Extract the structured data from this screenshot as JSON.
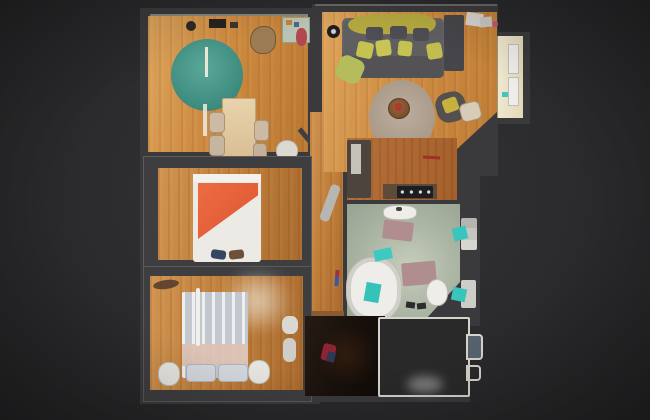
{
  "scene": {
    "type": "3d-dollhouse-top-down-view",
    "description": "Top-down dollhouse view of a scanned multi-room apartment floating on a dark background",
    "visible_text": "none",
    "background_color": "#2b2b2d",
    "wall_color": "#3a3a3d",
    "unscanned_room_outline_color": "#d6d3cc"
  },
  "palette": {
    "wood_floor_light": "#cd8a40",
    "wood_floor_dark": "#a96a2e",
    "teal_rug": "#4a9c8e",
    "beige_rug": "#b3a496",
    "sofa_gray": "#5f5f62",
    "pillow_yellow": "#c6c252",
    "blanket_mustard": "#b4a93f",
    "bed_blanket_orange": "#e4603a",
    "bathroom_tile_green": "#aab4a2",
    "towel_teal": "#3bc8be",
    "bath_mat_mauve": "#b08d8e",
    "entry_floor_dark": "#1c130e",
    "balcony_cream": "#efe8cf"
  },
  "rooms": [
    {
      "id": "dining-room",
      "label": "dining room",
      "furniture": [
        "teal round rug",
        "pale wood dining table",
        "four beige chairs",
        "top shelf objects",
        "kitchenette nook with counter and red figure",
        "white corner radiator",
        "open door leaf"
      ]
    },
    {
      "id": "living-room",
      "label": "living room",
      "furniture": [
        "gray sofa",
        "mustard throw blanket",
        "yellow cushions",
        "dark cushions",
        "green throw",
        "black round speaker",
        "round beige rug",
        "round coffee table",
        "dark armchair with yellow pillow",
        "side stool",
        "dark wardrobe",
        "white boxes near wall",
        "balcony window bay"
      ]
    },
    {
      "id": "kitchen",
      "label": "kitchen strip",
      "furniture": [
        "dark fridge cabinet with open light door",
        "counter with black cooktop",
        "red bar on floor"
      ]
    },
    {
      "id": "bathroom",
      "label": "bathroom",
      "furniture": [
        "white sink",
        "two mauve bath mats",
        "oval bathtub with teal towels",
        "toilet",
        "dark slippers",
        "wall shelves with teal towels"
      ]
    },
    {
      "id": "bedroom-1",
      "label": "bedroom with orange bed",
      "furniture": [
        "double bed with diagonal orange blanket",
        "two dark slippers at foot of bed"
      ]
    },
    {
      "id": "bedroom-2",
      "label": "bedroom with white bed",
      "furniture": [
        "double bed with pale striped duvet",
        "two quilted pillows",
        "white lamp pole",
        "two white nightstands",
        "white chair",
        "white bench",
        "privacy blur haze"
      ]
    },
    {
      "id": "hallway",
      "label": "central hallway",
      "furniture": [
        "leaning gray board",
        "small red-blue broom",
        "wooden threshold"
      ]
    },
    {
      "id": "entry-dark-room",
      "label": "unlit entry room",
      "furniture": [
        "red jacket on floor",
        "gray haze blob"
      ]
    },
    {
      "id": "unscanned-room",
      "label": "unscanned outlined room",
      "furniture": [
        "white wall outline",
        "two right-side wall protrusions",
        "blue-gray doorway fill"
      ]
    }
  ]
}
